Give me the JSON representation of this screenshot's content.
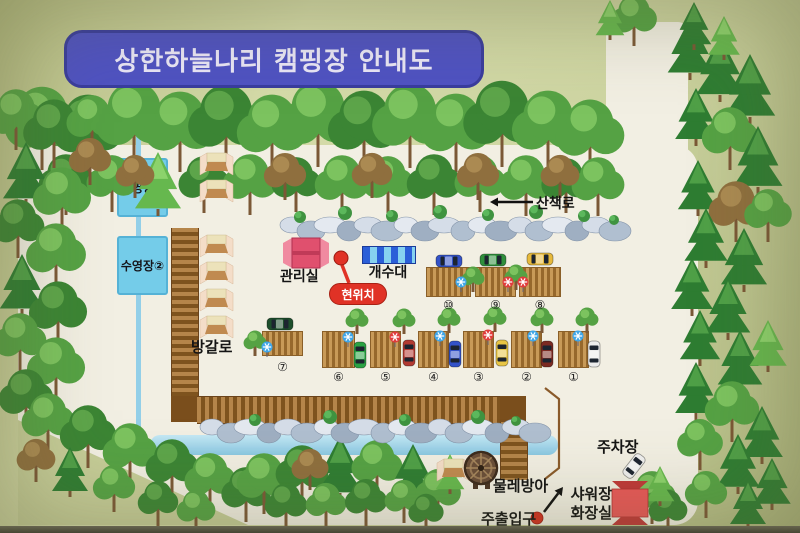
{
  "title": "상한하늘나리 캠핑장 안내도",
  "labels": {
    "pool1": "수영장①",
    "pool2": "수영장②",
    "trail": "산책로",
    "office": "관리실",
    "current_location": "현위치",
    "sink": "개수대",
    "bungalow": "방갈로",
    "waterwheel": "물레방아",
    "main_entrance": "주출입구",
    "shower": "샤워장",
    "toilet": "화장실",
    "parking": "주차장"
  },
  "sites": [
    "①",
    "②",
    "③",
    "④",
    "⑤",
    "⑥",
    "⑦",
    "⑧",
    "⑨",
    "⑩"
  ],
  "colors": {
    "sign_background": "#ccd3a0",
    "map_background": "#f2efe3",
    "title_background": "#4f52c3",
    "pool_blue": "#74cce9",
    "stream_blue": "#93cfe8",
    "road_brown": "#b5854a",
    "deck_tan": "#c89a58",
    "office_pink": "#e0506e",
    "building_red": "#e85050",
    "marker_red": "#e03226"
  },
  "icons": {
    "trail_arrow": "left-arrow-icon",
    "entrance_arrow": "up-right-arrow-icon",
    "current_location_marker": "red-dot-icon",
    "entrance_marker": "red-dot-icon",
    "tree": "tree-icon",
    "rock": "rock-icon",
    "tent": "tent-icon",
    "car": "car-icon",
    "waterwheel": "waterwheel-icon"
  }
}
